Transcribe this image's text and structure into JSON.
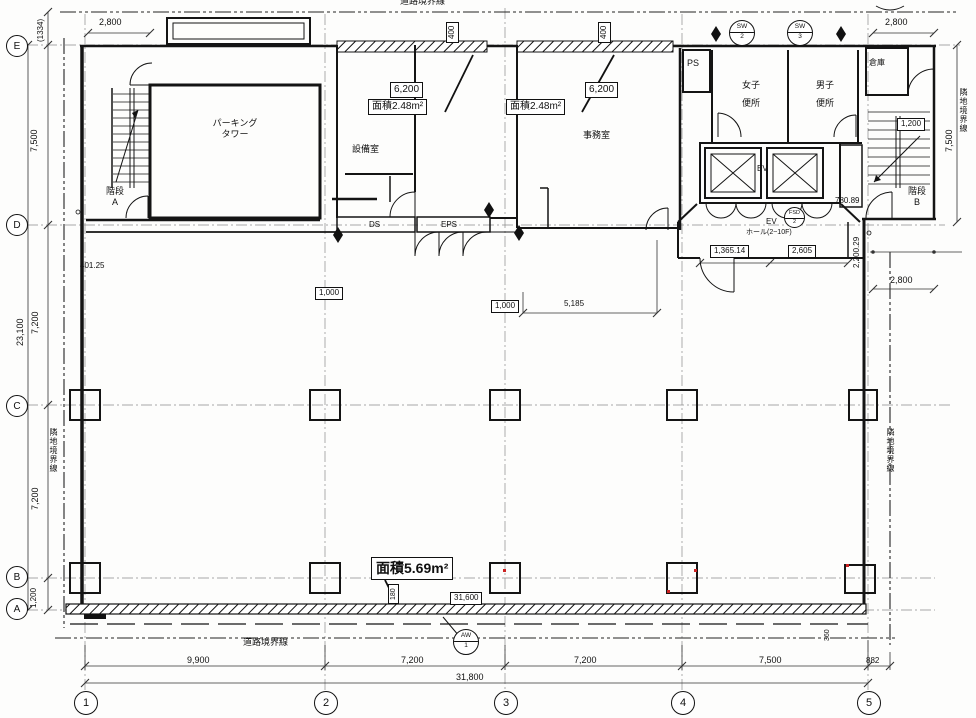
{
  "drawing": {
    "boundaries": {
      "top": "道路境界線",
      "bottom": "道路境界線",
      "left": "隣地境界線",
      "right_top": "隣地境界線",
      "right_mid": "隣地境界線"
    },
    "grid": {
      "rows": [
        "E",
        "D",
        "C",
        "B",
        "A"
      ],
      "cols": [
        "1",
        "2",
        "3",
        "4",
        "5"
      ]
    },
    "rooms": {
      "parking": "パーキング\nタワー",
      "stairs_a": "階段\nA",
      "equipment": "設備室",
      "office": "事務室",
      "ps": "PS",
      "women": "女子\n便所",
      "men": "男子\n便所",
      "storage": "倉庫",
      "stairs_b": "階段\nB",
      "elevator": "EV",
      "ev_hall_line1": "EV",
      "ev_hall_line2": "ホール(2~10F)",
      "ds": "DS",
      "eps": "EPS"
    },
    "areas": {
      "vent_a": "面積2.48m²",
      "vent_b": "面積2.48m²",
      "bottom": "面積5.69m²"
    },
    "markers": {
      "sw2": {
        "top": "SW",
        "bottom": "2"
      },
      "sw3": {
        "top": "SW",
        "bottom": "3"
      },
      "fsd": {
        "top": "FSD",
        "bottom": "2"
      },
      "aw": {
        "top": "AW",
        "bottom": "1"
      }
    },
    "dims": {
      "top_left_2800": "2,800",
      "paren_1334": "(1334)",
      "left_7500": "7,500",
      "left_23100": "23,100",
      "left_7200_u": "7,200",
      "left_7200_l": "7,200",
      "left_1200": "1,200",
      "w400_a": "400",
      "w400_b": "400",
      "w6200_a": "6,200",
      "w6200_b": "6,200",
      "top_right_2800": "2,800",
      "right_7500": "7,500",
      "stairs_1200": "1,200",
      "d780": "780.89",
      "d2200": "2,200.29",
      "d1365": "1,365.14",
      "d2605": "2,605",
      "right_2800": "2,800",
      "d40125": "401.25",
      "d1000_a": "1,000",
      "d1000_b": "1,000",
      "d5185": "5,185",
      "d180": "180",
      "d31600": "31,600",
      "d360": "360",
      "b9900": "9,900",
      "b7200_a": "7,200",
      "b7200_b": "7,200",
      "b7500": "7,500",
      "b882": "882",
      "b31800": "31,800"
    }
  }
}
